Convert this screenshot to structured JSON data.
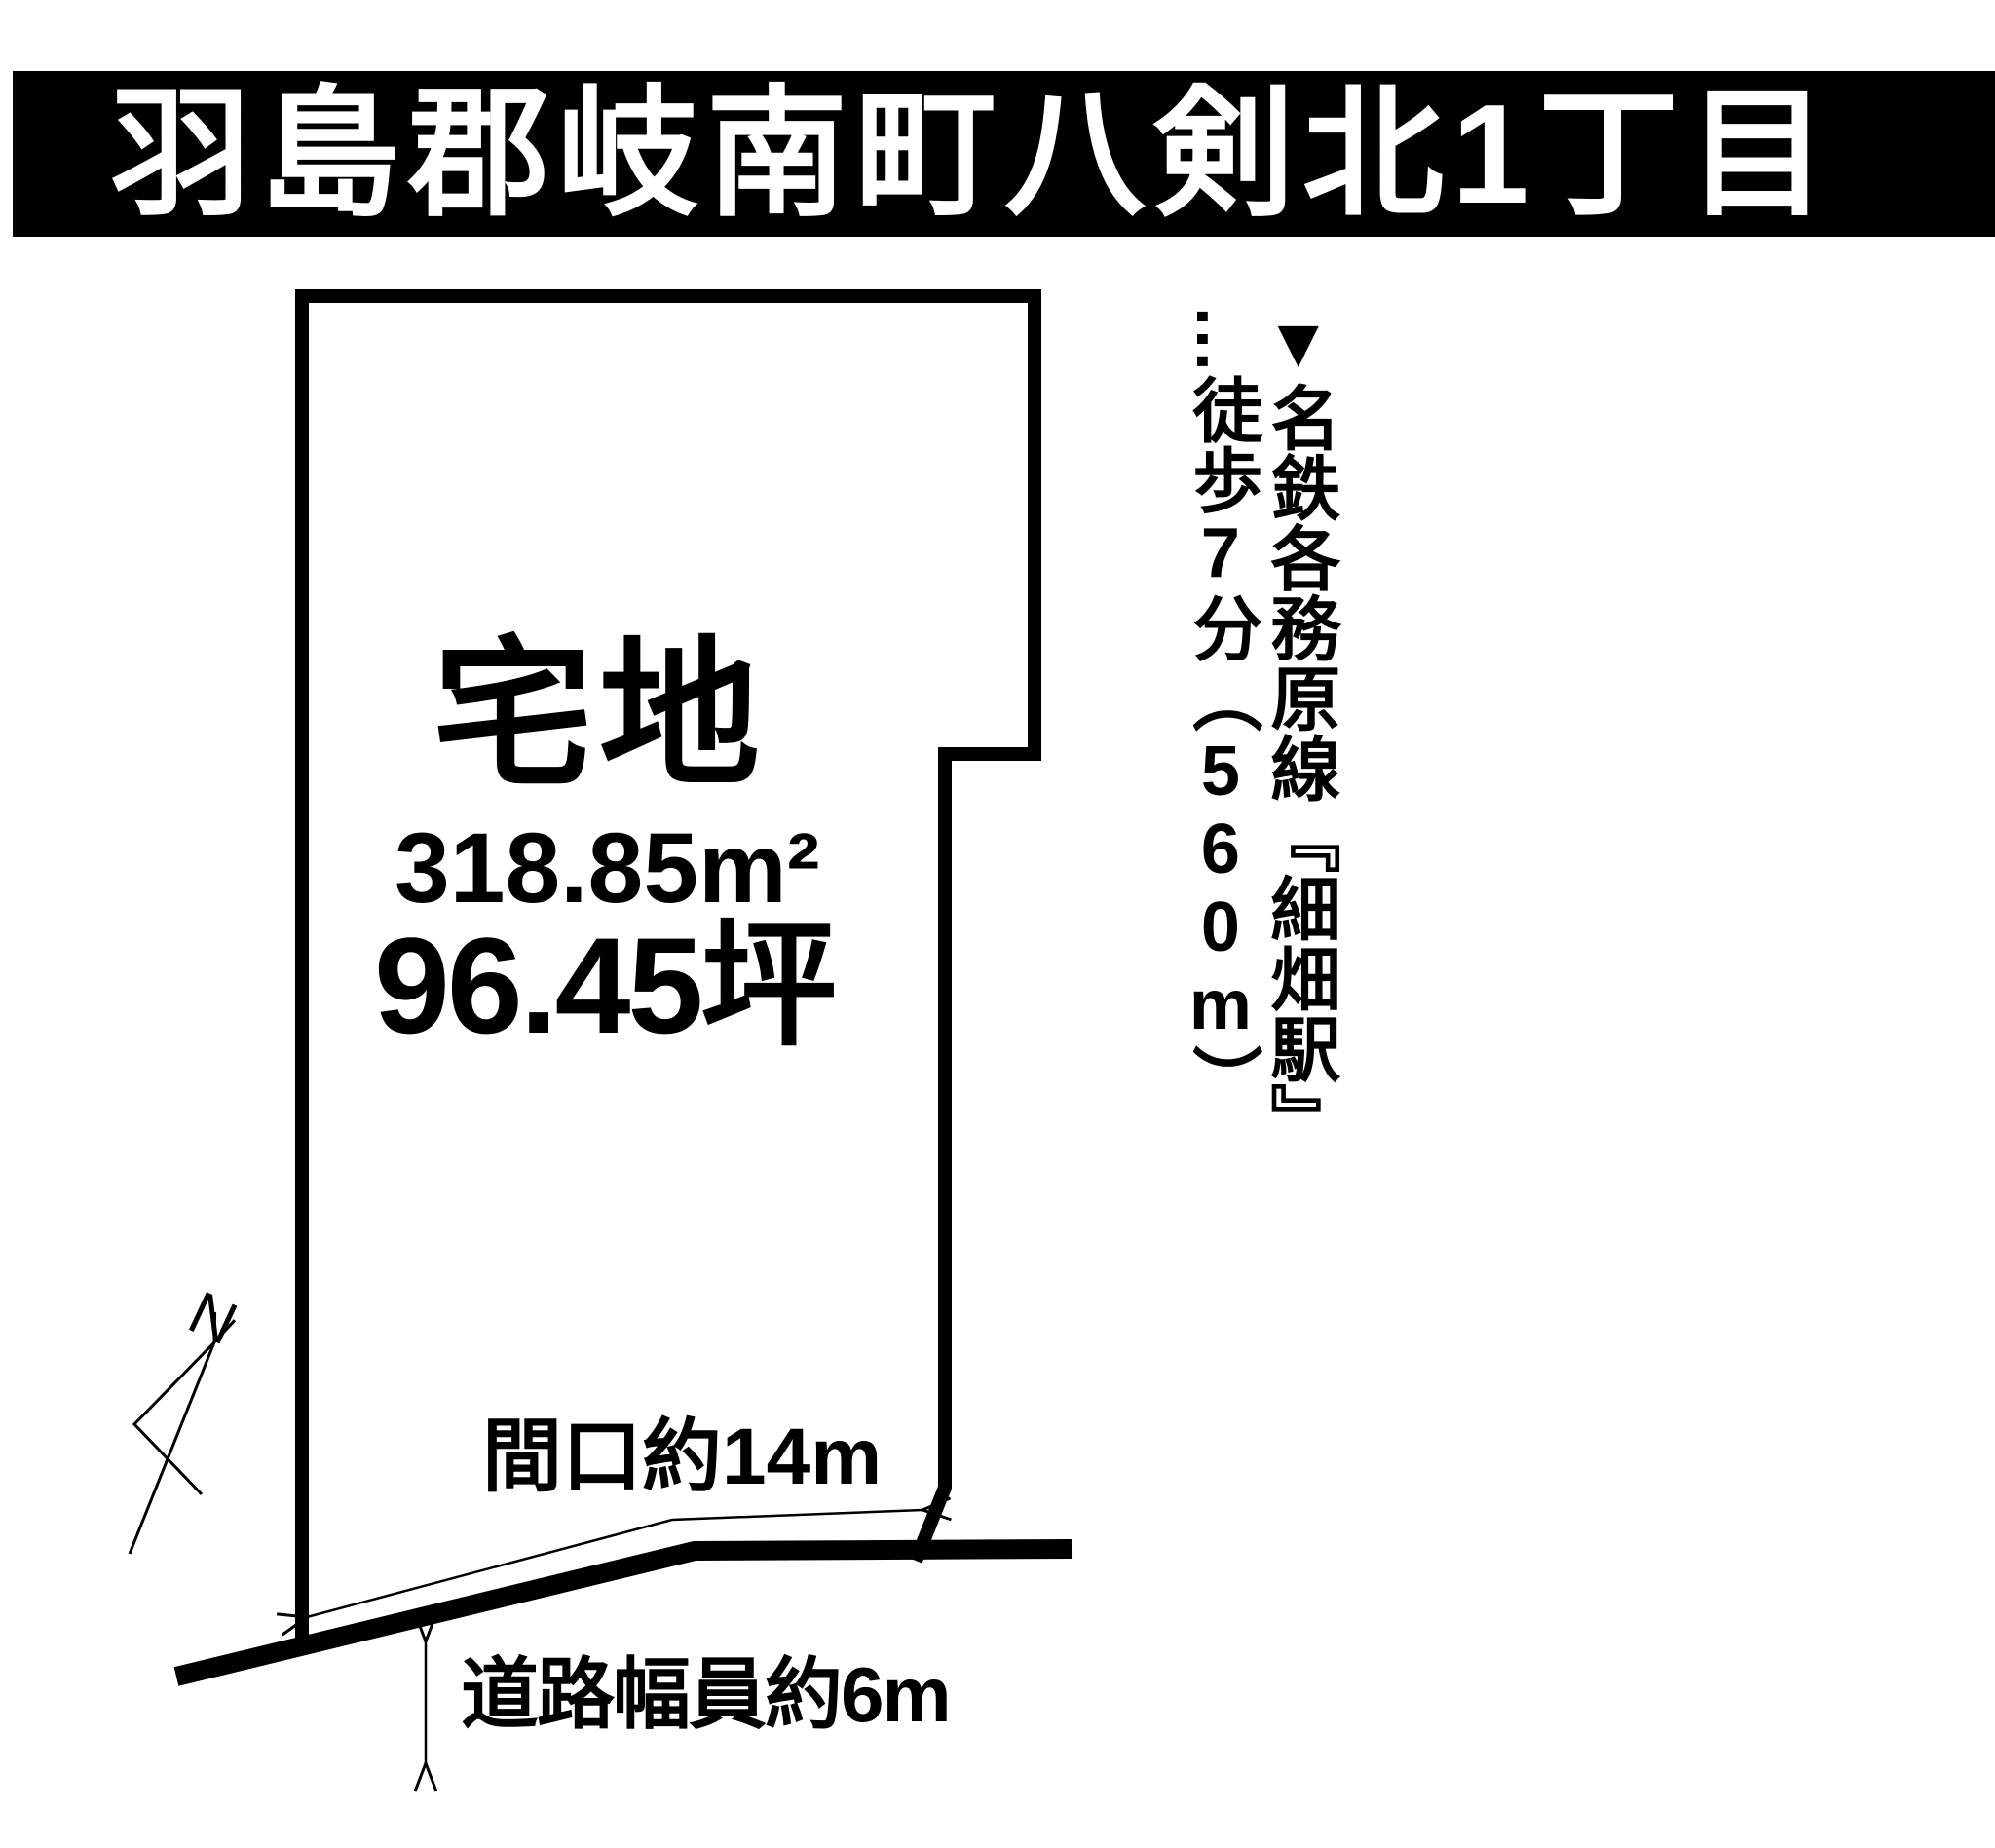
{
  "header": {
    "title": "羽島郡岐南町八剣北1丁目"
  },
  "parcel": {
    "land_type": "宅地",
    "area_m2": "318.85m²",
    "area_tsubo": "96.45坪"
  },
  "dimensions": {
    "frontage_label": "間口約14m",
    "road_width_label": "道路幅員約6m"
  },
  "access_note": {
    "marker": "▼",
    "station_line": "名鉄各務原線『細畑駅』",
    "leader": "…",
    "walk_info": "徒歩7分（560m）"
  },
  "compass": {
    "north_label": "N"
  },
  "colors": {
    "ink": "#000000",
    "paper": "#ffffff"
  }
}
